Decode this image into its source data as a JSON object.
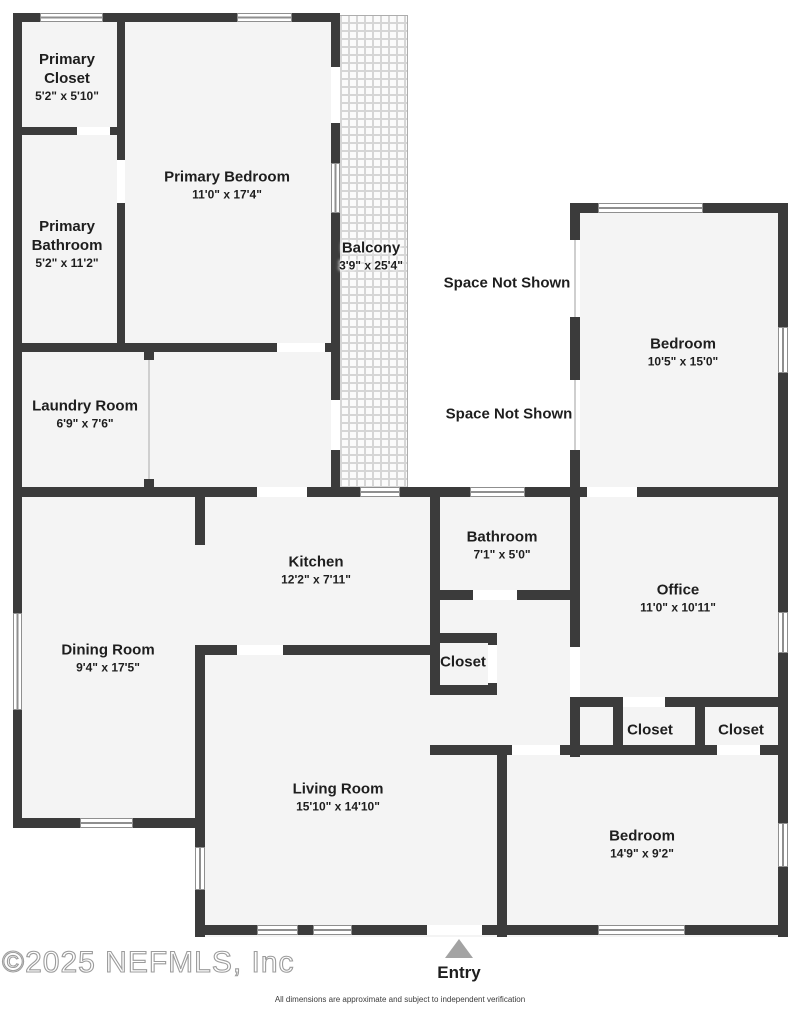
{
  "colors": {
    "wall": "#3b3b3b",
    "room_fill": "#f4f4f4",
    "window_line": "#8f8f8f",
    "balcony_grid": "#d6d6d6",
    "entry_arrow": "#a3a3a3",
    "label": "#1e1e1e"
  },
  "rooms": [
    {
      "id": "primary-closet",
      "name_lines": [
        "Primary",
        "Closet"
      ],
      "dims": "5'2\" x 5'10\"",
      "x": 67,
      "y": 77,
      "on_pattern": false
    },
    {
      "id": "primary-bedroom",
      "name_lines": [
        "Primary Bedroom"
      ],
      "dims": "11'0\" x 17'4\"",
      "x": 227,
      "y": 185,
      "on_pattern": false
    },
    {
      "id": "primary-bathroom",
      "name_lines": [
        "Primary",
        "Bathroom"
      ],
      "dims": "5'2\" x 11'2\"",
      "x": 67,
      "y": 244,
      "on_pattern": false
    },
    {
      "id": "balcony",
      "name_lines": [
        "Balcony"
      ],
      "dims": "3'9\" x 25'4\"",
      "x": 371,
      "y": 256,
      "on_pattern": true
    },
    {
      "id": "laundry-room",
      "name_lines": [
        "Laundry Room"
      ],
      "dims": "6'9\" x 7'6\"",
      "x": 85,
      "y": 414,
      "on_pattern": false
    },
    {
      "id": "bedroom-right",
      "name_lines": [
        "Bedroom"
      ],
      "dims": "10'5\" x 15'0\"",
      "x": 683,
      "y": 352,
      "on_pattern": false
    },
    {
      "id": "kitchen",
      "name_lines": [
        "Kitchen"
      ],
      "dims": "12'2\" x 7'11\"",
      "x": 316,
      "y": 570,
      "on_pattern": false
    },
    {
      "id": "bathroom",
      "name_lines": [
        "Bathroom"
      ],
      "dims": "7'1\" x 5'0\"",
      "x": 502,
      "y": 545,
      "on_pattern": false
    },
    {
      "id": "office",
      "name_lines": [
        "Office"
      ],
      "dims": "11'0\" x 10'11\"",
      "x": 678,
      "y": 598,
      "on_pattern": false
    },
    {
      "id": "closet-hall",
      "name_lines": [
        "Closet"
      ],
      "dims": "",
      "x": 463,
      "y": 662,
      "on_pattern": false
    },
    {
      "id": "closet-1",
      "name_lines": [
        "Closet"
      ],
      "dims": "",
      "x": 650,
      "y": 730,
      "on_pattern": false
    },
    {
      "id": "closet-2",
      "name_lines": [
        "Closet"
      ],
      "dims": "",
      "x": 741,
      "y": 730,
      "on_pattern": false
    },
    {
      "id": "dining-room",
      "name_lines": [
        "Dining Room"
      ],
      "dims": "9'4\" x 17'5\"",
      "x": 108,
      "y": 658,
      "on_pattern": false
    },
    {
      "id": "living-room",
      "name_lines": [
        "Living Room"
      ],
      "dims": "15'10\" x 14'10\"",
      "x": 338,
      "y": 797,
      "on_pattern": false
    },
    {
      "id": "bedroom-bottom",
      "name_lines": [
        "Bedroom"
      ],
      "dims": "14'9\" x 9'2\"",
      "x": 642,
      "y": 844,
      "on_pattern": false
    }
  ],
  "annotations": [
    {
      "text": "Space Not Shown",
      "x": 507,
      "y": 283
    },
    {
      "text": "Space Not Shown",
      "x": 509,
      "y": 414
    }
  ],
  "entry": {
    "label": "Entry"
  },
  "footer": {
    "copyright": "©2025 NEFMLS, Inc",
    "disclaimer": "All dimensions are approximate and subject to independent verification"
  },
  "geometry": {
    "fills": [
      [
        13,
        13,
        327,
        339
      ],
      [
        13,
        343,
        327,
        154
      ],
      [
        570,
        203,
        218,
        554
      ],
      [
        13,
        487,
        565,
        341
      ],
      [
        195,
        645,
        593,
        292
      ]
    ],
    "balcony_rect": [
      332,
      15,
      76,
      473
    ],
    "walls": [
      [
        13,
        13,
        327,
        9
      ],
      [
        13,
        13,
        9,
        339
      ],
      [
        13,
        127,
        112,
        8
      ],
      [
        117,
        13,
        8,
        339
      ],
      [
        13,
        343,
        327,
        9
      ],
      [
        331,
        13,
        9,
        479
      ],
      [
        144,
        352,
        10,
        8
      ],
      [
        144,
        479,
        10,
        9
      ],
      [
        13,
        487,
        565,
        10
      ],
      [
        195,
        487,
        10,
        58
      ],
      [
        195,
        645,
        10,
        292
      ],
      [
        13,
        352,
        9,
        476
      ],
      [
        13,
        818,
        192,
        10
      ],
      [
        195,
        645,
        245,
        10
      ],
      [
        430,
        497,
        10,
        198
      ],
      [
        430,
        590,
        147,
        10
      ],
      [
        430,
        633,
        67,
        10
      ],
      [
        430,
        685,
        67,
        10
      ],
      [
        488,
        633,
        9,
        62
      ],
      [
        430,
        745,
        358,
        10
      ],
      [
        497,
        745,
        10,
        192
      ],
      [
        195,
        925,
        312,
        10
      ],
      [
        507,
        925,
        281,
        10
      ],
      [
        570,
        203,
        10,
        554
      ],
      [
        570,
        203,
        218,
        10
      ],
      [
        778,
        203,
        10,
        734
      ],
      [
        570,
        487,
        218,
        10
      ],
      [
        570,
        697,
        218,
        10
      ],
      [
        613,
        707,
        10,
        48
      ],
      [
        695,
        707,
        10,
        48
      ]
    ],
    "doors": [
      [
        77,
        127,
        33,
        8
      ],
      [
        117,
        160,
        8,
        43
      ],
      [
        277,
        343,
        48,
        9
      ],
      [
        331,
        67,
        9,
        56
      ],
      [
        331,
        400,
        9,
        50
      ],
      [
        257,
        487,
        50,
        10
      ],
      [
        237,
        645,
        46,
        10
      ],
      [
        473,
        590,
        44,
        10
      ],
      [
        488,
        645,
        9,
        38
      ],
      [
        570,
        647,
        10,
        50
      ],
      [
        587,
        487,
        50,
        10
      ],
      [
        623,
        697,
        42,
        10
      ],
      [
        717,
        745,
        43,
        10
      ],
      [
        512,
        745,
        48,
        10
      ],
      [
        427,
        925,
        55,
        10
      ],
      [
        570,
        240,
        10,
        77
      ],
      [
        570,
        380,
        10,
        70
      ]
    ],
    "windows_h": [
      [
        40,
        13,
        63,
        9
      ],
      [
        237,
        13,
        55,
        9
      ],
      [
        360,
        487,
        40,
        10
      ],
      [
        470,
        487,
        55,
        10
      ],
      [
        80,
        818,
        53,
        10
      ],
      [
        598,
        203,
        105,
        10
      ],
      [
        257,
        925,
        41,
        10
      ],
      [
        313,
        925,
        39,
        10
      ],
      [
        598,
        925,
        87,
        10
      ]
    ],
    "windows_v": [
      [
        331,
        163,
        9,
        50
      ],
      [
        13,
        613,
        9,
        97
      ],
      [
        195,
        847,
        10,
        43
      ],
      [
        778,
        327,
        10,
        46
      ],
      [
        778,
        612,
        10,
        41
      ],
      [
        778,
        823,
        10,
        44
      ]
    ],
    "thin_lines": [
      [
        148,
        360,
        2,
        119
      ],
      [
        574,
        240,
        2,
        77
      ],
      [
        574,
        380,
        2,
        70
      ]
    ]
  }
}
